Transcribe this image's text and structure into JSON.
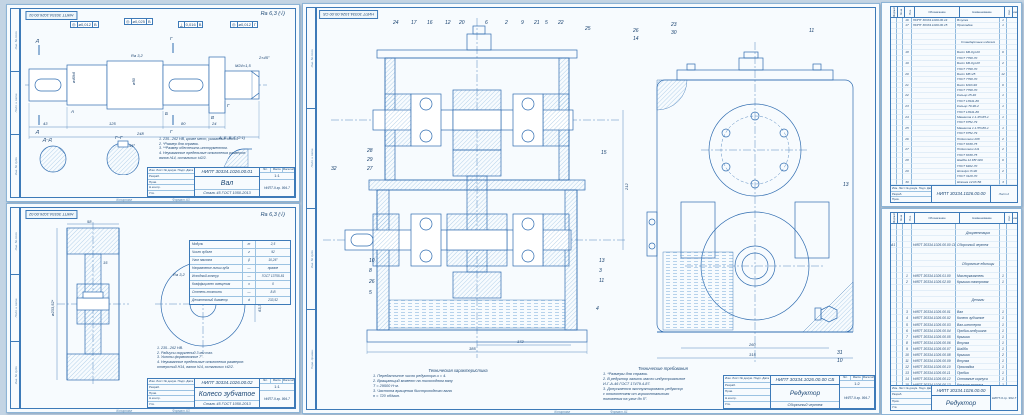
{
  "palette": {
    "bg": "#c3d4e4",
    "sheet": "#f7fbfe",
    "frame": "#3d7ab8",
    "line": "#2f6cb0",
    "hatch": "#74a9d8",
    "ink": "#17406e"
  },
  "tbl": {
    "sig": "Изм. Лист  № докум.  Подп.  Дата",
    "r1": "Разраб.",
    "r2": "Пров.",
    "r3": "Н.контр.",
    "r4": "Утв.",
    "lit": "Лит.",
    "mass": "Масса",
    "scale": "Масштаб",
    "copy": "Копировал",
    "format_label": "Формат"
  },
  "margins": [
    "Инв. № подл.",
    "Подп. и дата",
    "Инв. № дубл.",
    "Перв. примен."
  ],
  "shaft": {
    "stamp": "НИПТ 30334.1026.00.01",
    "rough": "Ra 6,3 (√)",
    "gdt": [
      {
        "s": "◎",
        "v": "ø0,012",
        "d": "В"
      },
      {
        "s": "◎",
        "v": "ø0,025",
        "d": "В"
      },
      {
        "s": "⟂",
        "v": "0,016",
        "d": "В"
      },
      {
        "s": "◎",
        "v": "ø0,012",
        "d": "Г"
      }
    ],
    "cut_d": "Д",
    "cut_g": "Г",
    "datums": [
      "А",
      "Б",
      "В",
      "Г"
    ],
    "sec1": "Д–Д",
    "sec2": "Г–Г",
    "detail": "А, Б, В, Г (2:1)",
    "dims": {
      "d43": "43",
      "d125": "125",
      "d80": "80",
      "d24": "24",
      "d248": "248",
      "dia1": "ø40k6",
      "dia2": "ø50",
      "thread": "M24×1,5",
      "cham": "2×45°",
      "ra": "Ra 3,2",
      "ang": "45°"
    },
    "notes": "1. 235...262 HB, кроме мест, указанных особо.\n2. *Размер для справок.\n3. **Размер обеспечить инструментом.\n4. Неуказанные предельные отклонения размеров:\nвалов h14, остальных ±t2/2.",
    "tb": {
      "designation": "НИПТ 30334.1026.00.01",
      "name": "Вал",
      "material": "Сталь 45 ГОСТ 1050-2013",
      "scale": "1:1",
      "org": "НИПТ-9 гр. 994-7"
    },
    "fmt": "Формат A3"
  },
  "gear": {
    "stamp": "НИПТ 30334.1026.00.02",
    "rough": "Ra 6,3 (√)",
    "params": [
      {
        "p": "Модуль",
        "s": "m",
        "v": "2,5"
      },
      {
        "p": "Число зубьев",
        "s": "z",
        "v": "92"
      },
      {
        "p": "Угол наклона",
        "s": "β",
        "v": "10,26°"
      },
      {
        "p": "Направление линии зуба",
        "s": "—",
        "v": "правое"
      },
      {
        "p": "Исходный контур",
        "s": "—",
        "v": "ГОСТ 13755-81"
      },
      {
        "p": "Коэффициент смещения",
        "s": "x",
        "v": "0"
      },
      {
        "p": "Степень точности",
        "s": "—",
        "v": "8-В"
      },
      {
        "p": "Делительный диаметр",
        "s": "d",
        "v": "233,52"
      }
    ],
    "dims": {
      "dia": "ø233,52*",
      "width": "58",
      "web": "15",
      "bore": "ø62H7",
      "key": "63,3",
      "ra": "Ra 3,2"
    },
    "notes": "1. 235...262 HB.\n2. Радиусы скруглений 3 мм max.\n3. Уклоны формовочные 7°.\n4. Неуказанные предельные отклонения размеров:\nотверстий H14, валов h14, остальных ±t2/2.",
    "tb": {
      "designation": "НИПТ 30334.1026.00.02",
      "name": "Колесо зубчатое",
      "material": "Сталь 45 ГОСТ 1050-2013",
      "scale": "1:1",
      "org": "НИПТ-9 гр. 994-7"
    },
    "fmt": "Формат A3"
  },
  "assembly": {
    "stamp": "НИПТ 30334.1026.00.00 СБ",
    "balloons_main": [
      "24",
      "17",
      "16",
      "12",
      "20",
      "6",
      "2",
      "9",
      "21",
      "5",
      "22",
      "25",
      "28",
      "29",
      "27",
      "32",
      "15",
      "10",
      "8",
      "26",
      "5",
      "13",
      "3",
      "11",
      "4"
    ],
    "balloons_side": [
      "26",
      "14",
      "23",
      "30",
      "11",
      "13",
      "31",
      "10"
    ],
    "dims": {
      "overall": "385",
      "part": "172",
      "side1": "260",
      "side2": "315",
      "height": "212"
    },
    "tech_char": {
      "title": "Техническая характеристика",
      "lines": "1. Передаточное число редуктора u = 4.\n2. Вращающий момент на тихоходном валу\nТ = 29500 Н·м.\n3. Частота вращения быстроходного вала\nn = 720 об/мин."
    },
    "tech_req": {
      "title": "Технические требования",
      "lines": "1. *Размеры для справок.\n2. В редуктор залить масло индустриальное\nИ-Г-А-46 ГОСТ 17479.4-87.\n3. Допускается эксплуатировать редуктор\nс отклонением от горизонтального\nположения на угол до 5°."
    },
    "tb": {
      "designation": "НИПТ 30334.1026.00.00 СБ",
      "name": "Редуктор",
      "sub": "Сборочный чертеж",
      "scale": "1:2",
      "org": "НИПТ-9 гр. 994-7"
    },
    "fmt": "Формат A1"
  },
  "spec2": {
    "headers": [
      "Формат",
      "Зона",
      "Поз.",
      "Обозначение",
      "Наименование",
      "Кол.",
      "Примеч."
    ],
    "rows": [
      {
        "p": "16",
        "d": "НИПТ 30334.1026.00.14",
        "n": "Втулка",
        "q": "1"
      },
      {
        "p": "17",
        "d": "НИПТ 30334.1026.00.15",
        "n": "Прокладка",
        "q": "1"
      },
      {},
      {},
      {
        "n": "Стандартные изделия",
        "cls": "c cn sec"
      },
      {},
      {
        "p": "18",
        "n": "Болт М6-6g×20",
        "q": "6"
      },
      {
        "n": "ГОСТ 7798-70"
      },
      {
        "p": "19",
        "n": "Болт М6-6g×28",
        "q": "2"
      },
      {
        "n": "ГОСТ 7798-70"
      },
      {
        "p": "20",
        "n": "Болт М8×25",
        "q": "12"
      },
      {
        "n": "ГОСТ 7798-70"
      },
      {
        "p": "21",
        "n": "Болт М10×40",
        "q": "6"
      },
      {
        "n": "ГОСТ 7798-70"
      },
      {
        "p": "22",
        "n": "Кольцо 25-40",
        "q": "1"
      },
      {
        "n": "ГОСТ 13941-86"
      },
      {
        "p": "23",
        "n": "Кольцо 70-90-2",
        "q": "1"
      },
      {
        "n": "ГОСТ 13941-86"
      },
      {
        "p": "24",
        "n": "Манжета 1.1-45×65-1",
        "q": "1"
      },
      {
        "n": "ГОСТ 8752-79"
      },
      {
        "p": "25",
        "n": "Манжета 1.1-55×80-1",
        "q": "1"
      },
      {
        "n": "ГОСТ 8752-79"
      },
      {
        "p": "26",
        "n": "Подшипник 208",
        "q": "2"
      },
      {
        "n": "ГОСТ 8338-75"
      },
      {
        "p": "27",
        "n": "Подшипник 211",
        "q": "2"
      },
      {
        "n": "ГОСТ 8338-75"
      },
      {
        "p": "28",
        "n": "Шайба 12.65Г.029",
        "q": "6"
      },
      {
        "n": "ГОСТ 6402-70"
      },
      {
        "p": "29",
        "n": "Штифт 8×40",
        "q": "2"
      },
      {
        "n": "ГОСТ 3128-70"
      },
      {
        "p": "30",
        "n": "Шпонка 12×8×56",
        "q": "3"
      },
      {
        "n": "ГОСТ 23360-78"
      }
    ],
    "footer": {
      "designation": "НИПТ 30334.1026.00.00",
      "org": "Лист 2"
    }
  },
  "spec1": {
    "headers": [
      "Формат",
      "Зона",
      "Поз.",
      "Обозначение",
      "Наименование",
      "Кол.",
      "Примеч."
    ],
    "rows": [
      {},
      {
        "n": "Документация",
        "cls": "c cn sec"
      },
      {},
      {
        "f": "А1",
        "d": "НИПТ 30334.1026.00.00 СБ",
        "n": "Сборочный чертеж"
      },
      {},
      {},
      {
        "n": "Сборочные единицы",
        "cls": "c cn sec"
      },
      {},
      {
        "p": "1",
        "d": "НИПТ 30334.1026.01.00",
        "n": "Маслоуказатель",
        "q": "1"
      },
      {
        "p": "2",
        "d": "НИПТ 30334.1026.02.00",
        "n": "Крышка смотровая",
        "q": "1"
      },
      {},
      {},
      {
        "n": "Детали",
        "cls": "c cn sec"
      },
      {},
      {
        "p": "3",
        "d": "НИПТ 30334.1026.00.01",
        "n": "Вал",
        "q": "1"
      },
      {
        "p": "4",
        "d": "НИПТ 30334.1026.00.02",
        "n": "Колесо зубчатое",
        "q": "1"
      },
      {
        "p": "5",
        "d": "НИПТ 30334.1026.00.03",
        "n": "Вал-шестерня",
        "q": "1"
      },
      {
        "p": "6",
        "d": "НИПТ 30334.1026.00.04",
        "n": "Пробка-отдушина",
        "q": "1"
      },
      {
        "p": "7",
        "d": "НИПТ 30334.1026.00.05",
        "n": "Крышка",
        "q": "1"
      },
      {
        "p": "8",
        "d": "НИПТ 30334.1026.00.06",
        "n": "Втулка",
        "q": "1"
      },
      {
        "p": "9",
        "d": "НИПТ 30334.1026.00.07",
        "n": "Шайба",
        "q": "1"
      },
      {
        "p": "10",
        "d": "НИПТ 30334.1026.00.08",
        "n": "Крышка",
        "q": "2"
      },
      {
        "p": "11",
        "d": "НИПТ 30334.1026.00.09",
        "n": "Втулка",
        "q": "1"
      },
      {
        "p": "12",
        "d": "НИПТ 30334.1026.00.10",
        "n": "Прокладка",
        "q": "1"
      },
      {
        "p": "13",
        "d": "НИПТ 30334.1026.00.11",
        "n": "Пробка",
        "q": "1"
      },
      {
        "p": "14",
        "d": "НИПТ 30334.1026.00.12",
        "n": "Основание корпуса",
        "q": "1"
      },
      {
        "p": "15",
        "d": "НИПТ 30334.1026.00.13",
        "n": "Крышка корпуса",
        "q": "1"
      }
    ],
    "footer": {
      "designation": "НИПТ 30334.1026.00.00",
      "name": "Редуктор",
      "org": "НИПТ-9 гр. 994-7"
    }
  }
}
